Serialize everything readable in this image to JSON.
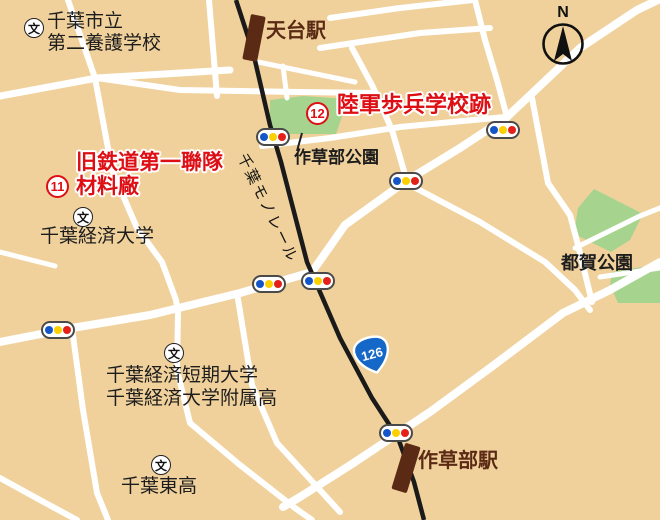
{
  "colors": {
    "background_tan": "#f0d19b",
    "road_white": "#ffffff",
    "park_green": "#a6d48e",
    "rail_black": "#1a1a1a",
    "station_brown": "#5a2a15",
    "highlight_red": "#dd0f15",
    "route_badge_blue": "#1668c8",
    "signal_blue": "#1456c8",
    "signal_yellow": "#fdd000",
    "signal_red": "#e32119"
  },
  "compass": {
    "label": "N"
  },
  "railway": {
    "label": "千葉モノレール"
  },
  "route_badge": {
    "number": "126"
  },
  "stations": {
    "tendai": "天台駅",
    "sakusabe": "作草部駅"
  },
  "parks": {
    "sakusabe": "作草部公園",
    "tsuga": "都賀公園"
  },
  "sites": {
    "site11": {
      "number": "11",
      "line1": "旧鉄道第一聯隊",
      "line2": "材料廠"
    },
    "site12": {
      "number": "12",
      "name": "陸軍歩兵学校跡"
    }
  },
  "schools": {
    "icon_glyph": "文",
    "yogo": {
      "line1": "千葉市立",
      "line2": "第二養護学校"
    },
    "keizai_univ": {
      "name": "千葉経済大学"
    },
    "keizai_tandai": {
      "line1": "千葉経済短期大学",
      "line2": "千葉経済大学附属高"
    },
    "higashi": {
      "name": "千葉東高"
    }
  }
}
